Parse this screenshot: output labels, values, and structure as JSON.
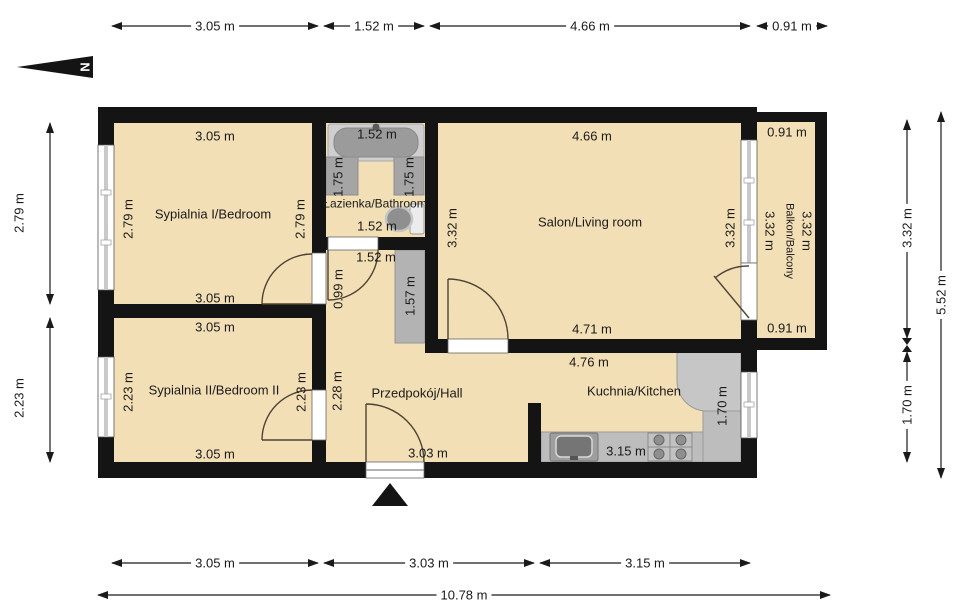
{
  "north": {
    "label": "N"
  },
  "rooms": {
    "bedroom1": {
      "name": "Sypialnia I/Bedroom",
      "dim_top": "3.05 m",
      "dim_bottom": "3.05 m",
      "dim_left": "2.79 m",
      "dim_right": "2.79 m"
    },
    "bedroom2": {
      "name": "Sypialnia II/Bedroom II",
      "dim_top": "3.05 m",
      "dim_bottom": "3.05 m",
      "dim_left": "2.23 m",
      "dim_right": "2.23 m"
    },
    "bathroom": {
      "name": "Łazienka/Bathroom",
      "dim_tub": "1.52 m",
      "dim_bottom": "1.52 m",
      "dim_left": "1.75 m",
      "dim_right": "1.75 m"
    },
    "living_room": {
      "name": "Salon/Living room",
      "dim_top": "4.66 m",
      "dim_bottom": "4.71 m",
      "dim_left": "3.32 m",
      "dim_right": "3.32 m"
    },
    "kitchen": {
      "name": "Kuchnia/Kitchen",
      "dim_top": "4.76 m",
      "dim_counter": "3.15 m",
      "dim_right": "1.70 m"
    },
    "hall": {
      "name": "Przedpokój/Hall",
      "dim_top": "1.52 m",
      "dim_upper_left": "0.99 m",
      "dim_closet": "1.57 m",
      "dim_left": "2.28 m",
      "dim_bottom": "3.03 m"
    },
    "balcony": {
      "name": "Balkon/Balcony",
      "dim_top": "0.91 m",
      "dim_bottom": "0.91 m",
      "dim_left": "3.32 m",
      "dim_right": "3.32 m"
    }
  },
  "dimensions": {
    "top": [
      "3.05 m",
      "1.52 m",
      "4.66 m",
      "0.91 m"
    ],
    "bottom": [
      "3.05 m",
      "3.03 m",
      "3.15 m"
    ],
    "bottom_total": "10.78 m",
    "left": [
      "2.79 m",
      "2.23 m"
    ],
    "right": [
      "3.32 m",
      "1.70 m"
    ],
    "right_total": "5.52 m"
  },
  "colors": {
    "floor": "#f3dfb5",
    "wall": "#141414",
    "fixture_gray": "#bdbdbd"
  }
}
